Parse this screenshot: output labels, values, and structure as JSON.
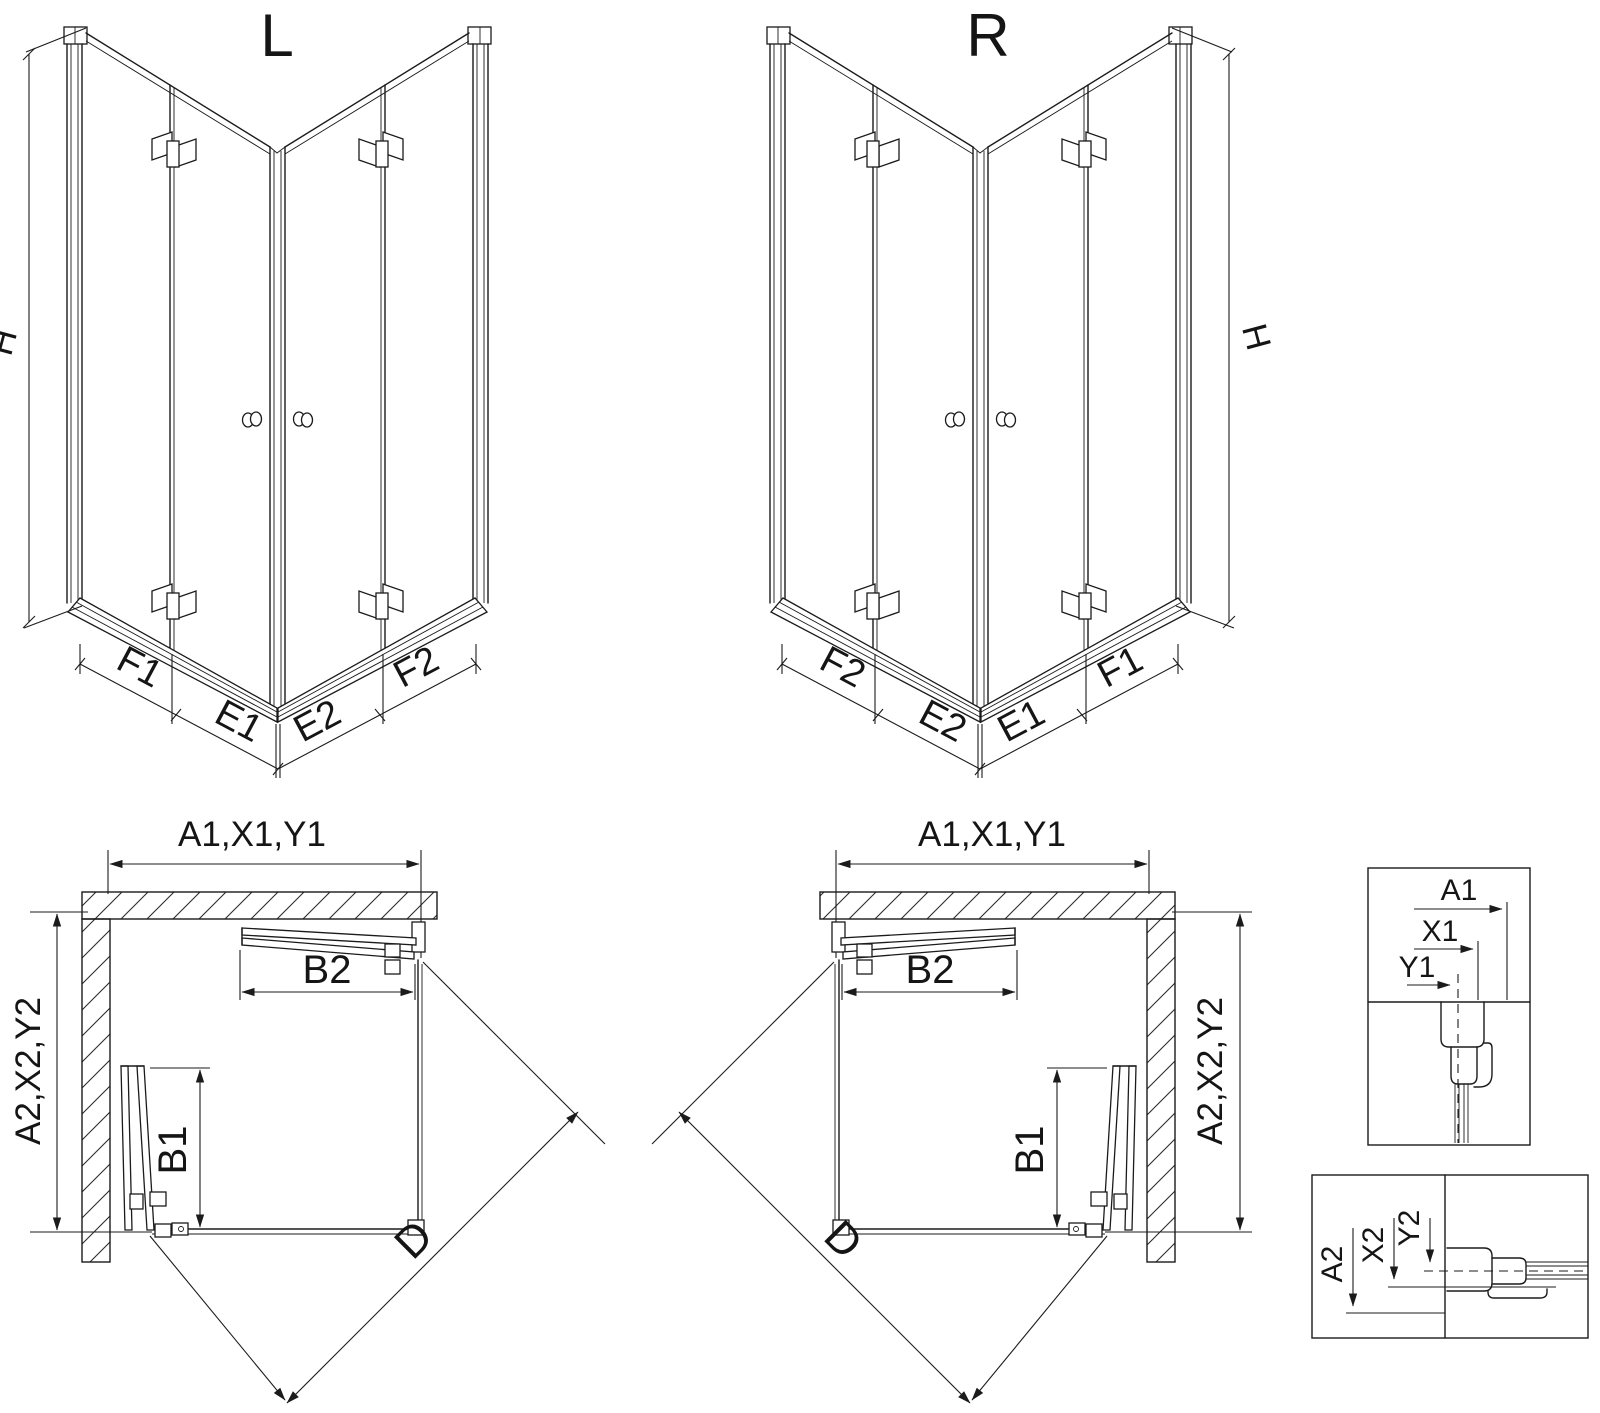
{
  "drawing": {
    "iso_left": {
      "title": "L",
      "height": "H",
      "segments": [
        "F1",
        "E1",
        "E2",
        "F2"
      ]
    },
    "iso_right": {
      "title": "R",
      "height": "H",
      "segments": [
        "F2",
        "E2",
        "E1",
        "F1"
      ]
    },
    "plan_left": {
      "width": "A1,X1,Y1",
      "depth": "A2,X2,Y2",
      "door_front": "B2",
      "door_side": "B1",
      "diagonal": "D"
    },
    "plan_right": {
      "width": "A1,X1,Y1",
      "depth": "A2,X2,Y2",
      "door_front": "B2",
      "door_side": "B1",
      "diagonal": "D"
    },
    "detail_horizontal": {
      "dims": [
        "A1",
        "X1",
        "Y1"
      ]
    },
    "detail_vertical": {
      "dims": [
        "A2",
        "X2",
        "Y2"
      ]
    }
  }
}
